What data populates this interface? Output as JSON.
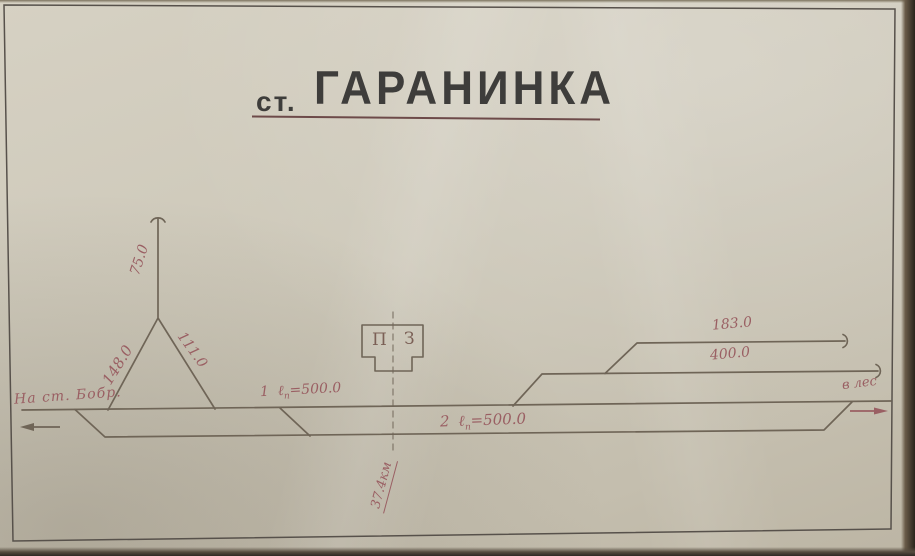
{
  "title": {
    "prefix": "ст.",
    "name": "ГАРАНИНКА"
  },
  "directions": {
    "left": "На ст. Бобр.",
    "right": "в лес"
  },
  "wye": {
    "top_length": "75.0",
    "left_length": "148.0",
    "right_length": "111.0"
  },
  "sidings": {
    "top_length": "183.0",
    "middle_length": "400.0"
  },
  "tracks": {
    "track1": {
      "num": "1",
      "symbol": "ℓ",
      "sub": "п",
      "value": "=500.0"
    },
    "track2": {
      "num": "2",
      "symbol": "ℓ",
      "sub": "п",
      "value": "=500.0"
    }
  },
  "building": {
    "left": "П",
    "right": "З"
  },
  "km_post": "37.4км",
  "colors": {
    "paper": "#cdc8b9",
    "track_ink": "#6f6557",
    "label_ink": "#9a5f63",
    "title_ink": "#3e3d3b",
    "title_underline": "#6d4a49",
    "frame": "#57514b"
  }
}
